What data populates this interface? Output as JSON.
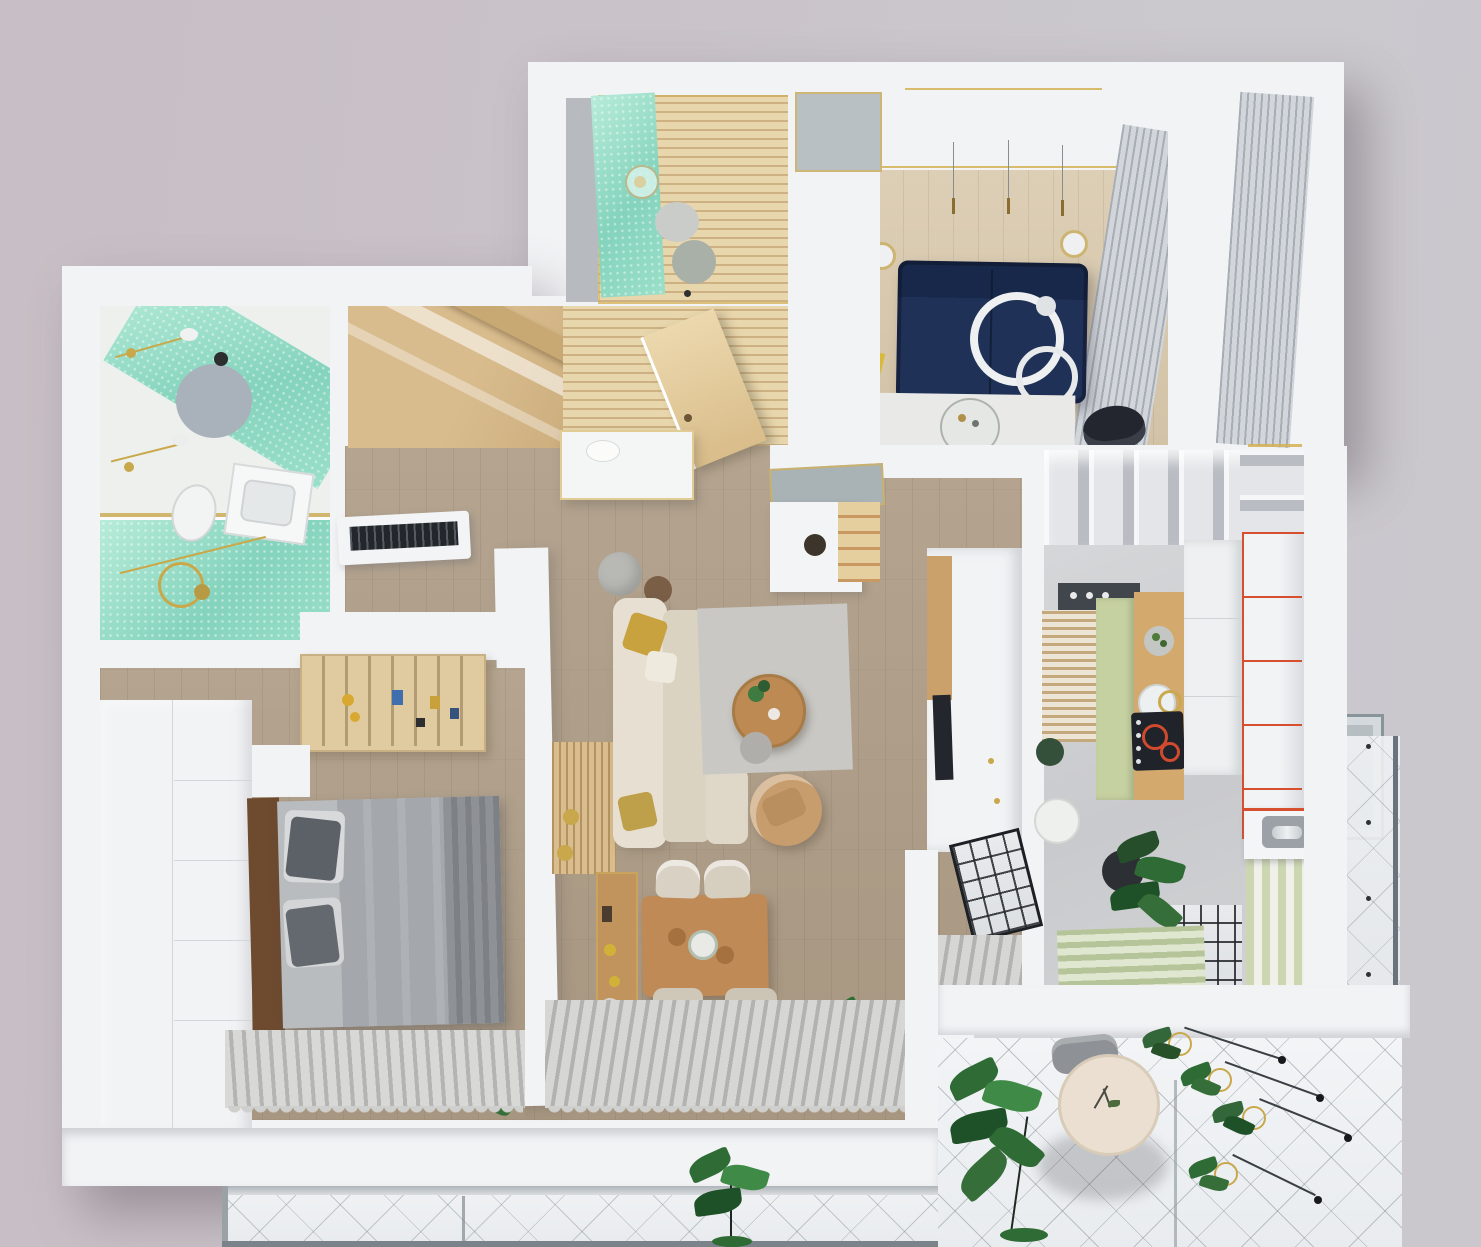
{
  "scene": {
    "kind": "3d-apartment-floorplan-top-view-render",
    "has_text": false,
    "rooms": [
      {
        "name": "main-bathroom",
        "position": "top-left",
        "features": [
          "teal-mosaic-shower",
          "sink",
          "toilet",
          "round-rug",
          "gold-fixtures",
          "glass-screen"
        ]
      },
      {
        "name": "wc-bathroom",
        "position": "top-center",
        "features": [
          "teal-mosaic-wall",
          "wood-slat-floor",
          "toilet",
          "pendant-lamp"
        ]
      },
      {
        "name": "study-lounge",
        "position": "top-right",
        "features": [
          "navy-sofa",
          "white-ring-decor",
          "glass-coffee-table",
          "dark-chair",
          "white-desk",
          "pendant-lights",
          "ribbed-curtain-walls",
          "white-rug"
        ]
      },
      {
        "name": "entry-hall",
        "position": "center-top",
        "features": [
          "wood-wardrobe",
          "open-wood-door",
          "wood-slat-floor",
          "console-table",
          "shoe-bench-with-mirror",
          "ac-unit"
        ]
      },
      {
        "name": "living-room",
        "position": "center",
        "features": [
          "cream-l-sofa",
          "gold-pillows",
          "gray-rug",
          "round-wood-coffee-table",
          "tan-armchair",
          "gray-pouf",
          "wood-slat-divider",
          "tv-wall"
        ]
      },
      {
        "name": "dining-area",
        "position": "center-bottom",
        "features": [
          "wood-table",
          "four-cream-chairs",
          "flower-centerpiece",
          "bar-shelf",
          "striped-rug",
          "plants",
          "black-grid-partition"
        ]
      },
      {
        "name": "bedroom",
        "position": "bottom-left",
        "features": [
          "gray-double-bed",
          "dark-pillows",
          "white-wardrobe-wall",
          "overbed-book-shelf",
          "striped-rug",
          "plant"
        ]
      },
      {
        "name": "kitchen",
        "position": "right",
        "features": [
          "sage-green-cabinets",
          "wood-counter",
          "black-cooktop-red-rings",
          "red-trimmed-shelves",
          "white-cube-shelves",
          "window-blinds",
          "sink-unit",
          "plant",
          "green-striped-mat",
          "balcony-door"
        ]
      },
      {
        "name": "balcony-bottom-right",
        "position": "bottom-right",
        "features": [
          "round-cream-table",
          "gray-chair",
          "monstera-plant",
          "hanging-planters",
          "diamond-grid-tile",
          "glass-balustrade"
        ]
      },
      {
        "name": "balcony-bottom-strip",
        "position": "bottom",
        "features": [
          "glass-railing",
          "diamond-grid-tile",
          "monstera-plant"
        ]
      }
    ],
    "counts": {
      "dining_chairs": 4,
      "study_pendant_lights": 3,
      "white_decor_rings": 2,
      "cooktop_red_rings": 2,
      "hanging_planter_clusters": 4
    }
  },
  "palette": {
    "background_left": "#c8bec5",
    "background_right": "#cbc9ce",
    "wall_white": "#f2f3f5",
    "teal_mosaic": "#8fd9c2",
    "navy_sofa": "#1f3156",
    "cream_sofa": "#e0d9ca",
    "gold_accent": "#c9a84c",
    "gold_pillow": "#c8a23e",
    "bed_gray": "#a4a7ab",
    "headboard_brown": "#6e4a2f",
    "wood_floor_living": "#ac9d89",
    "wood_entry": "#dccbad",
    "wood_table": "#bf8a55",
    "tan_armchair": "#c79d6e",
    "sage_green": "#c6d1a2",
    "red_trim": "#d6502f",
    "cooktop_black": "#202329",
    "plant_green": "#2f6b35",
    "rug_stripe_light": "#d6d6d4",
    "rug_stripe_dark": "#b2b2b0",
    "glass_tile": "#eef0f2"
  }
}
